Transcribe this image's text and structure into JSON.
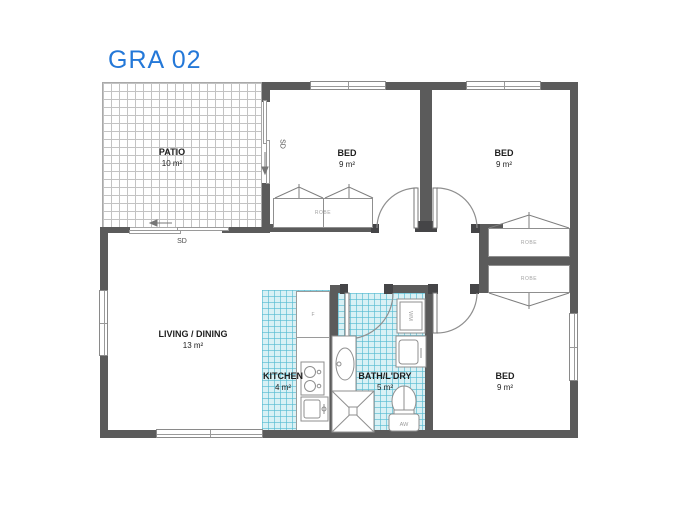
{
  "title": "GRA 02",
  "colors": {
    "accent": "#2478d8",
    "wall": "#5b5b5b",
    "tile_fill": "#d9f1f5"
  },
  "rooms": {
    "patio": {
      "name": "PATIO",
      "area": "10 m²"
    },
    "bed_top_middle": {
      "name": "BED",
      "area": "9 m²"
    },
    "bed_top_right": {
      "name": "BED",
      "area": "9 m²"
    },
    "living_dining": {
      "name": "LIVING / DINING",
      "area": "13 m²"
    },
    "kitchen": {
      "name": "KITCHEN",
      "area": "4 m²"
    },
    "bath_laundry": {
      "name": "BATH/L'DRY",
      "area": "5 m²"
    },
    "bed_bottom_right": {
      "name": "BED",
      "area": "9 m²"
    }
  },
  "labels": {
    "robe": "ROBE",
    "sliding_door": "SD"
  },
  "fixtures": {
    "washing_machine": "WM",
    "toilet_cistern": "AW",
    "fridge": "F"
  }
}
